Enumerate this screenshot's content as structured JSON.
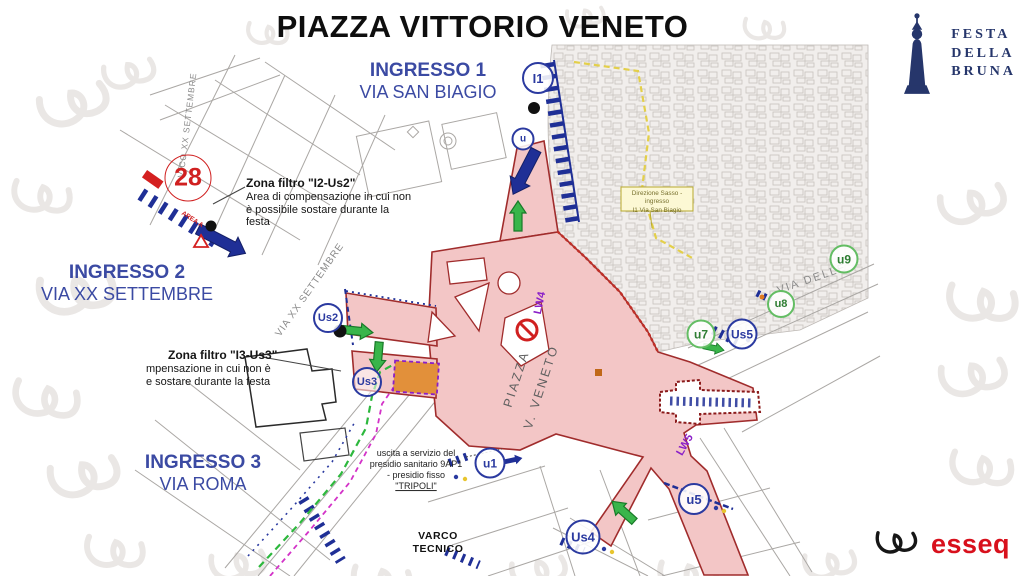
{
  "header": {
    "title": "PIAZZA VITTORIO VENETO"
  },
  "logos": {
    "festa": {
      "lines": [
        "FESTA",
        "DELLA",
        "BRUNA"
      ],
      "color": "#26366b"
    },
    "esseq": {
      "text": "esseq",
      "color": "#d8101c"
    }
  },
  "map": {
    "entrances": [
      {
        "name": "INGRESSO 1",
        "street": "VIA SAN BIAGIO"
      },
      {
        "name": "INGRESSO 2",
        "street": "VIA XX SETTEMBRE"
      },
      {
        "name": "INGRESSO 3",
        "street": "VIA ROMA"
      }
    ],
    "filter_zones": [
      {
        "title": "Zona filtro \"I2-Us2\"",
        "lines": [
          "Area di compensazione in cui non",
          "è possibile sostare durante la",
          "festa"
        ]
      },
      {
        "title": "Zona filtro \"I3-Us3\"",
        "lines": [
          "mpensazione in cui non è",
          "e sostare durante la festa"
        ]
      }
    ],
    "medical_note": {
      "lines": [
        "uscita a servizio del",
        "presidio sanitario 9AP1",
        "- presidio fisso",
        "\"TRIPOLI\""
      ]
    },
    "sasso_note": {
      "lines": [
        "Direzione Sasso - ingresso",
        "I1 Via San Biagio"
      ]
    },
    "varco_tecnico": {
      "lines": [
        "VARCO",
        "TECNICO"
      ]
    },
    "square_name": {
      "lines": [
        "PIAZZA",
        "V. VENETO"
      ]
    },
    "street_names": {
      "xx_settembre": "VIA XX SETTEMBRE",
      "vico_xx": "VICO XX SETTEMBRE",
      "delle": "VIA DELLE"
    },
    "route_labels": {
      "lw4": "LW4",
      "lw5": "LW5"
    },
    "distance_marker": "28",
    "area_label": "AREA A",
    "gates": [
      {
        "id": "I1",
        "color": "blue"
      },
      {
        "id": "u",
        "color": "blue"
      },
      {
        "id": "Us2",
        "color": "blue"
      },
      {
        "id": "Us3",
        "color": "blue"
      },
      {
        "id": "u1",
        "color": "blue"
      },
      {
        "id": "Us4",
        "color": "blue"
      },
      {
        "id": "u5",
        "color": "blue"
      },
      {
        "id": "Us5",
        "color": "blue"
      },
      {
        "id": "u7",
        "color": "green"
      },
      {
        "id": "u8",
        "color": "green"
      },
      {
        "id": "u9",
        "color": "green"
      }
    ],
    "colors": {
      "piazza_fill": "#f3c6c6",
      "piazza_border": "#a02c2c",
      "entrance_text": "#3b4aa3",
      "navy": "#1f2f96",
      "gate_blue": "#2b3aa0",
      "gate_green": "#63bd63",
      "green_route": "#2db83d",
      "magenta_route": "#d332c8",
      "purple": "#8a1fc8",
      "red": "#d02020",
      "yellow_route": "#e3cf4a",
      "sassi_fill": "#f1eeec"
    }
  }
}
